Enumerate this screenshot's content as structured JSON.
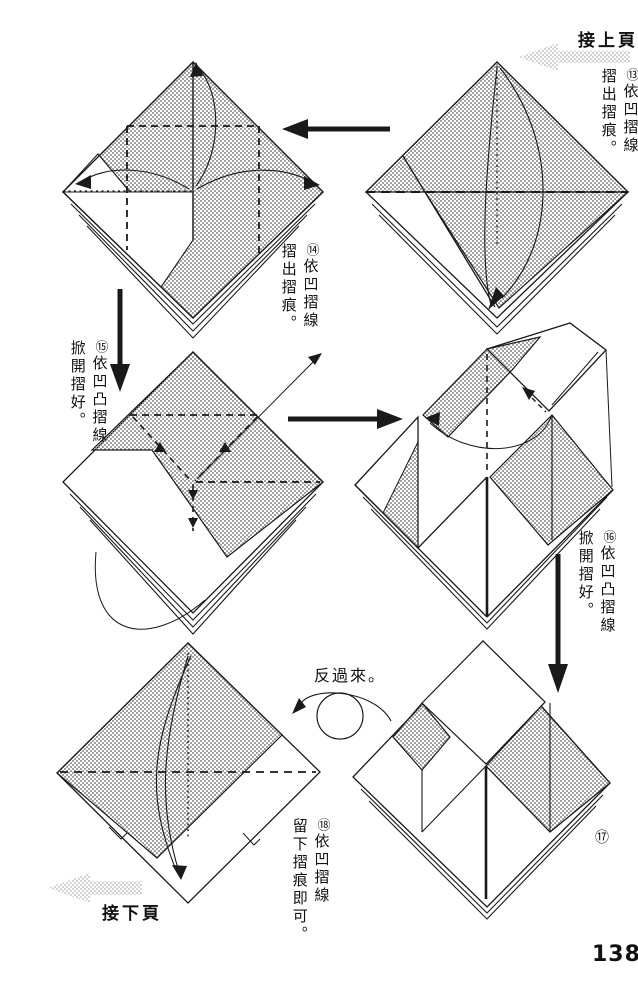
{
  "page": {
    "number": "138"
  },
  "nav": {
    "prev_page_label": "接上頁",
    "next_page_label": "接下頁"
  },
  "labels": {
    "turn_over": "反過來。"
  },
  "steps": {
    "s13": {
      "num": "⑬",
      "line1": "依凹摺線",
      "line2": "摺出摺痕。"
    },
    "s14": {
      "num": "⑭",
      "line1": "依凹摺線",
      "line2": "摺出摺痕。"
    },
    "s15": {
      "num": "⑮",
      "line1": "依凹凸摺線",
      "line2": "掀開摺好。"
    },
    "s16": {
      "num": "⑯",
      "line1": "依凹凸摺線",
      "line2": "掀開摺好。"
    },
    "s17": {
      "num": "⑰"
    },
    "s18": {
      "num": "⑱",
      "line1": "依凹摺線",
      "line2": "留下摺痕即可。"
    }
  },
  "colors": {
    "ink": "#1a1a1a",
    "paper": "#ffffff",
    "halftone_dot": "#8f8f8f",
    "gray_arrow": "#c2c2c2"
  }
}
